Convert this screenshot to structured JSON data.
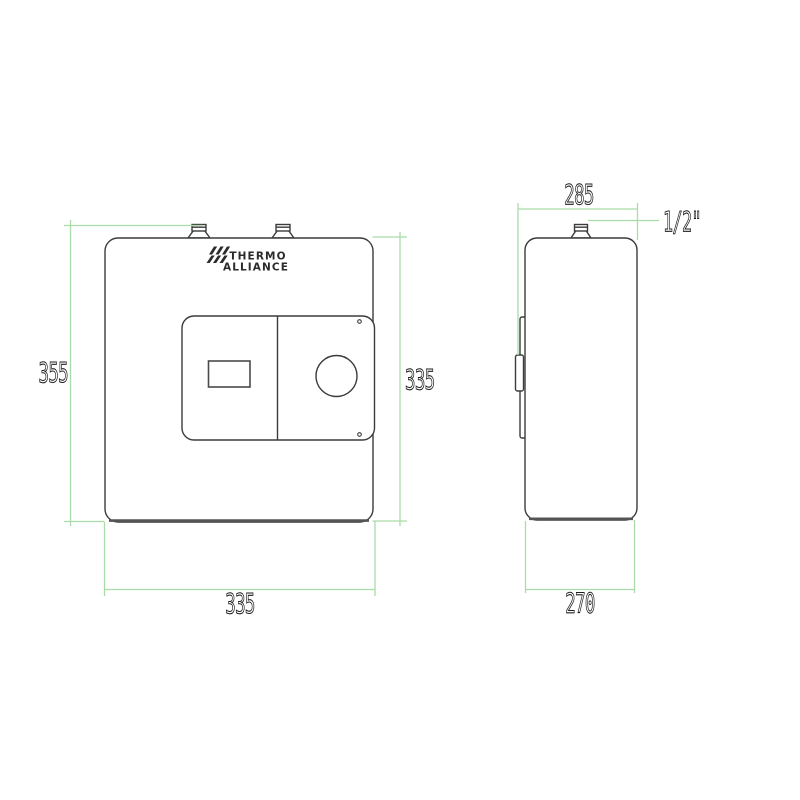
{
  "drawing": {
    "title": "Thermo Alliance water heater dimensional drawing",
    "brand": {
      "name_line1": "THERMO",
      "name_line2": "ALLIANCE"
    },
    "labels": {
      "overall_height": "355",
      "body_height": "335",
      "body_width": "335",
      "depth_overall": "285",
      "depth_body": "270",
      "connection_size": "1/2\""
    },
    "colors": {
      "dimension_line": "#a9dca9",
      "outline": "#3c3c3c",
      "text": "#1c1c1c",
      "background": "#ffffff"
    },
    "views": {
      "front": "front-view",
      "side": "side-view"
    }
  }
}
